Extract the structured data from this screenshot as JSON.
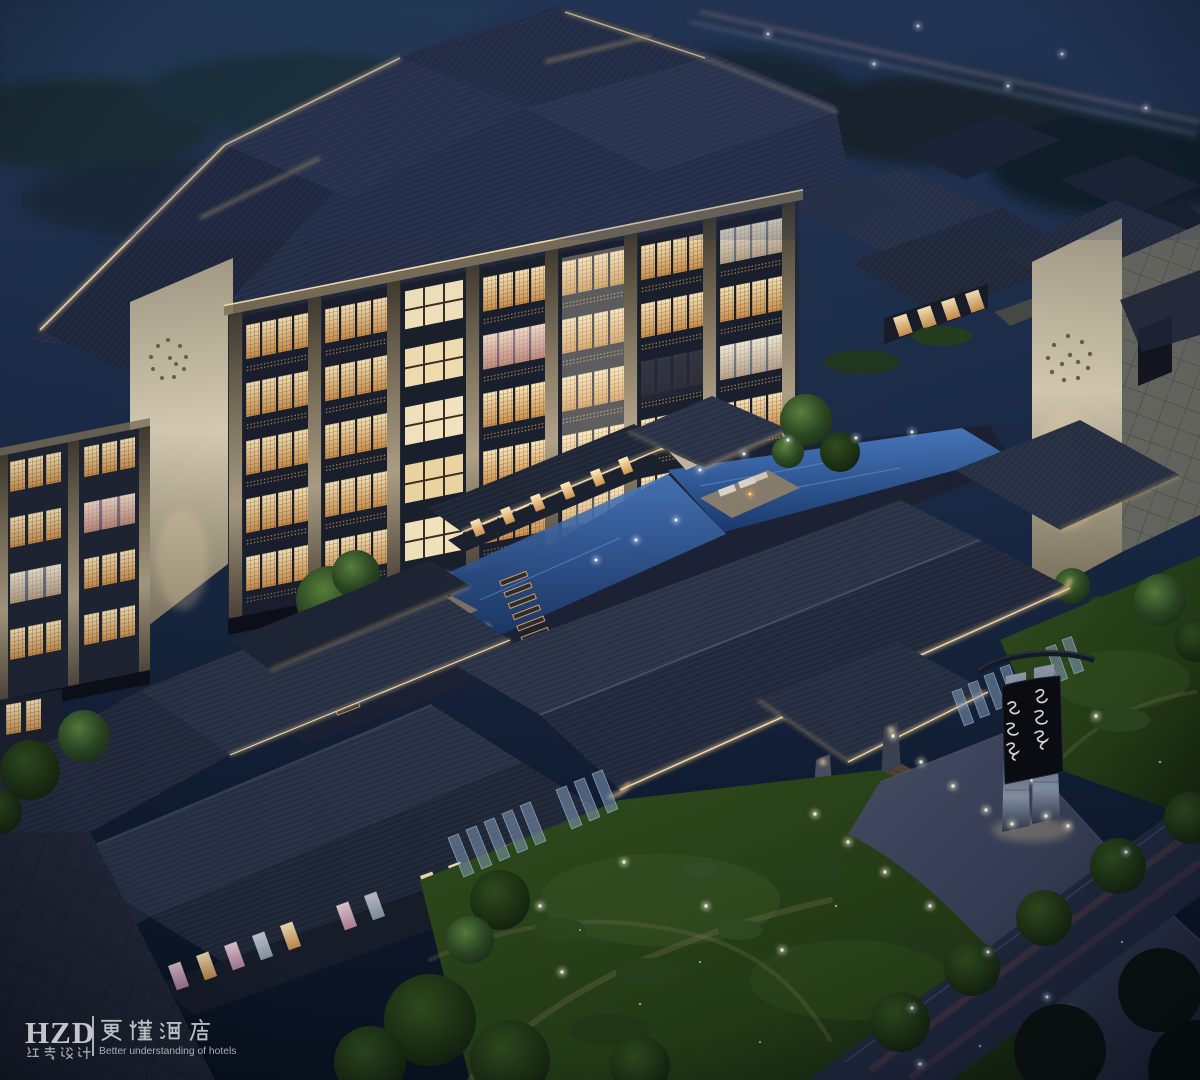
{
  "scene": {
    "subject": "Aerial night rendering of a Chinese-style courtyard hotel complex",
    "view": "bird's-eye perspective at night",
    "features": [
      "multi-storey guestroom block with glowing lattice windows",
      "courtyard reflecting pools with stepping-stone paths and lounge islands",
      "tiled hip roofs with warm eave lighting and upturned corners",
      "entrance porte-cochere with stone driveway and ground lights",
      "lawn gardens with winding footpaths and shrubs",
      "perimeter road with tree row and street lights",
      "illuminated twin-pillar entrance totem sign",
      "white gable wall with perforated circular motif"
    ]
  },
  "palette": {
    "sky": "#1b2c49",
    "roof_dark": "#1f2636",
    "roof_mid": "#2a3347",
    "roof_light": "#39455e",
    "eave_glow": "#f3cd8a",
    "window_warm": "#f5d49a",
    "window_amber": "#d49a52",
    "window_pink": "#e3b9c8",
    "window_cool": "#dfe6ee",
    "water": "#27508f",
    "lawn": "#2b471b",
    "tree": "#3a5c33",
    "wall_cream": "#d9d0b8",
    "road": "#222b42",
    "drive": "#39415a"
  },
  "watermark": {
    "logo_acronym": "HZD",
    "logo_cn": "红专设计",
    "brand_cn": "更懂酒店",
    "tagline_en": "Better understanding of hotels"
  },
  "entrance_sign": {
    "form": "twin tapered stone pillars with dark plaque and curved timber cap",
    "calligraphy": "two vertical columns of stylized cursive Chinese brush characters"
  }
}
